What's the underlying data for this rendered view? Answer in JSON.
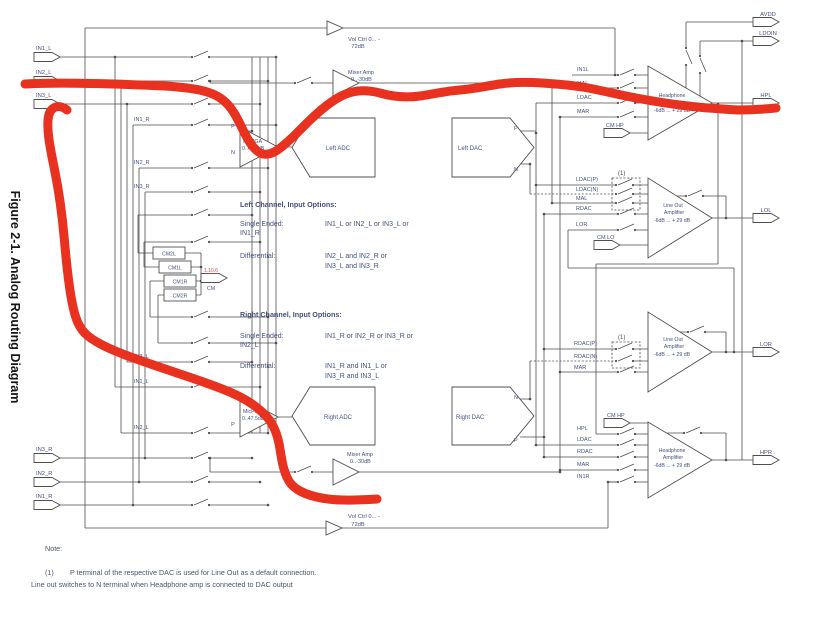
{
  "figure_title": "Figure 2-1. Analog Routing Diagram",
  "colors": {
    "text": "#44507d",
    "line": "#4f4f4f",
    "note": "#4a5568",
    "red_annotation": "#e8311f",
    "link": "#c0504a"
  },
  "rails": {
    "top_vol_l1": "Vol Ctrl 0... -",
    "top_vol_l2": "72dB",
    "bot_vol_l1": "Vol Ctrl 0... -",
    "bot_vol_l2": "72dB"
  },
  "connectors": {
    "in1l": "IN1_L",
    "in2l": "IN2_L",
    "in3l": "IN3_L",
    "in3r": "IN3_R",
    "in2r": "IN2_R",
    "in1r": "IN1_R",
    "avdd": "AVDD",
    "ldoin": "LDOIN",
    "hpl": "HPL",
    "lol": "LOL",
    "lor": "LOR",
    "hpr": "HPR",
    "cm": "CM",
    "cm_ref": "1.10.6",
    "cmhp_top": "CM HP",
    "cmlo": "CM LO",
    "cmhp_bot": "CM HP"
  },
  "wire_labels": {
    "t1": "IN1_R",
    "t2": "IN2_R",
    "t3": "IN3_R",
    "b1": "IN3_L",
    "b2": "IN1_L",
    "b3": "IN2_L"
  },
  "cm_boxes": {
    "b1": "CM2L",
    "b2": "CM1L",
    "b3": "CM1R",
    "b4": "CM2R"
  },
  "pn": {
    "p": "P",
    "n": "N"
  },
  "pga": {
    "left_l1": "MicPGA",
    "left_l2": "0..47.5dB",
    "right_l1": "MicPGA",
    "right_l2": "0..47.5dB"
  },
  "blocks": {
    "left_adc": "Left ADC",
    "left_dac": "Left DAC",
    "right_adc": "Right ADC",
    "right_dac": "Right DAC"
  },
  "mixers": {
    "top_l1": "Mixer Amp",
    "top_l2": "0..-30dB",
    "bot_l1": "Mixer Amp",
    "bot_l2": "0..-30dB"
  },
  "amps": {
    "hpl": {
      "l1": "Headphone",
      "l2": "Amplifier",
      "gain": "-6dB ... + 29 dB",
      "in1": "IN1L",
      "in2": "MAL",
      "in3": "LDAC",
      "in4": "MAR"
    },
    "lol": {
      "l1": "Line Out",
      "l2": "Amplifier",
      "gain": "-6dB ... + 29 dB",
      "ref": "(1)",
      "in1": "LDAC(P)",
      "in2": "LDAC(N)",
      "in3": "MAL",
      "in4": "RDAC",
      "in5": "LOR"
    },
    "lor": {
      "l1": "Line Out",
      "l2": "Amplifier",
      "gain": "-6dB ... + 29 dB",
      "ref": "(1)",
      "in1": "RDAC(P)",
      "in2": "RDAC(N)",
      "in3": "MAR"
    },
    "hpr": {
      "l1": "Headphone",
      "l2": "Amplifier",
      "gain": "-6dB ... + 29 dB",
      "in1": "HPL",
      "in2": "LDAC",
      "in3": "RDAC",
      "in4": "MAR",
      "in5": "IN1R"
    }
  },
  "text_left": {
    "title": "Left Channel, Input Options:",
    "se": "Single Ended:",
    "se_v1": "IN1_L  or  IN2_L  or  IN3_L  or",
    "se_v2": "IN1_R",
    "diff": "Differential:",
    "diff_v1": "IN2_L and IN2_R  or",
    "diff_v2": "IN3_L and IN3_R"
  },
  "text_right": {
    "title": "Right Channel, Input Options:",
    "se": "Single Ended:",
    "se_v1": "IN1_R  or  IN2_R  or  IN3_R  or",
    "se_v2": "IN2_L",
    "diff": "Differential:",
    "diff_v1": "IN1_R and IN1_L  or",
    "diff_v2": "IN3_R and IN3_L"
  },
  "note": {
    "title": "Note:",
    "ref": "(1)",
    "line1": "P terminal of the respective DAC is used for Line Out as a default connection.",
    "line2": "Line out switches to N terminal when Headphone amp is connected to DAC output"
  }
}
